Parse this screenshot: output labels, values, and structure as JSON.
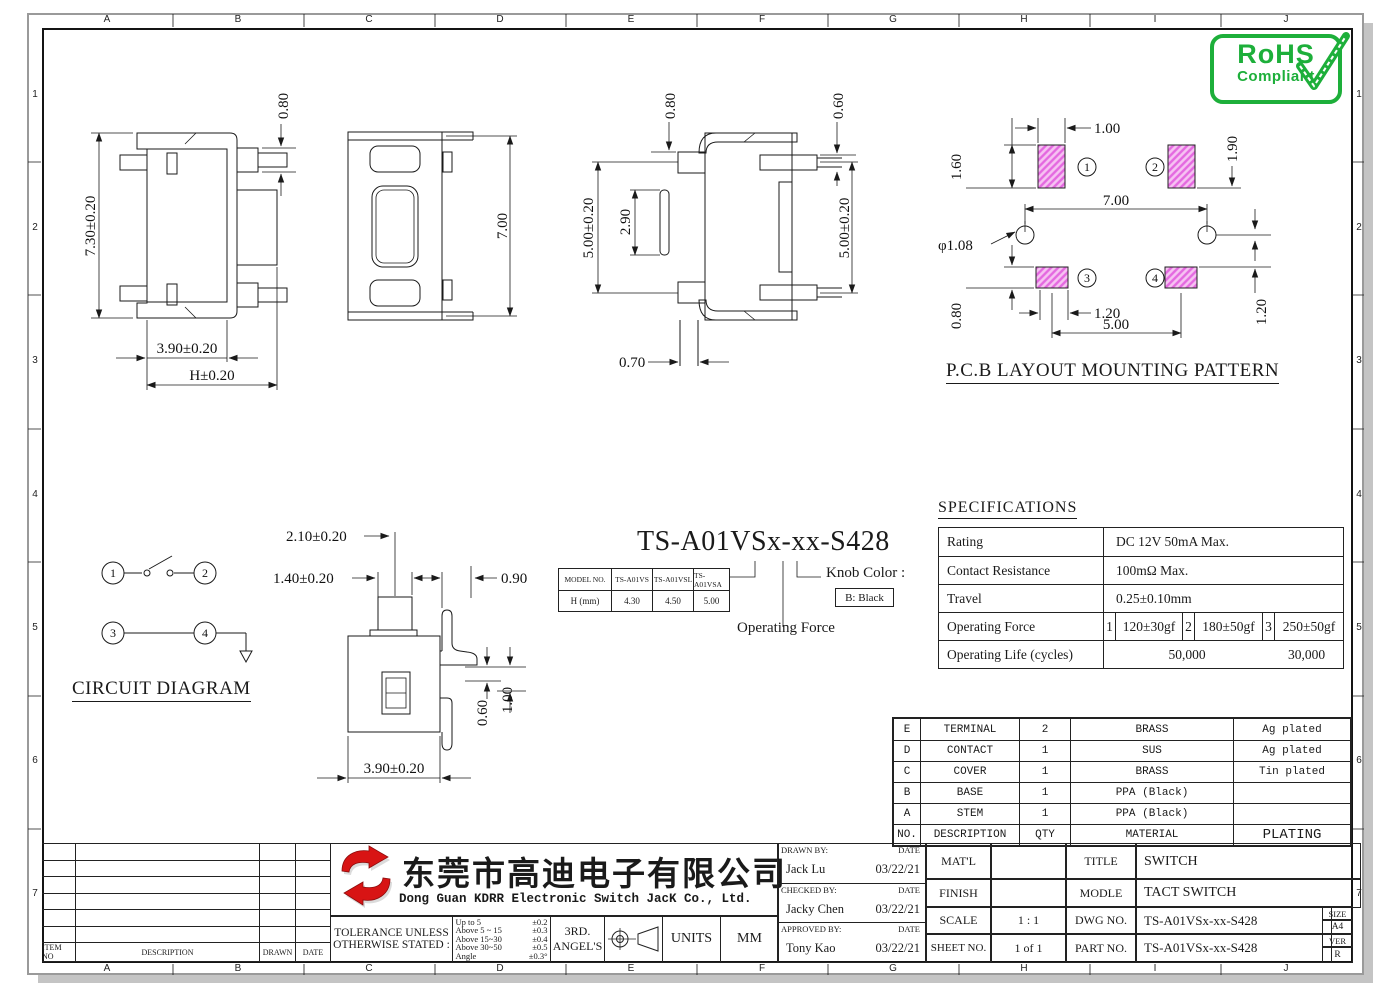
{
  "frame": {
    "grid_letters": [
      "A",
      "B",
      "C",
      "D",
      "E",
      "F",
      "G",
      "H",
      "I",
      "J"
    ],
    "grid_numbers": [
      "1",
      "2",
      "3",
      "4",
      "5",
      "6",
      "7"
    ]
  },
  "rohs": {
    "title": "RoHS",
    "subtitle": "Compliant",
    "color": "#1daf3a"
  },
  "views": {
    "front": {
      "d080": "0.80",
      "d730": "7.30±0.20",
      "d390": "3.90±0.20",
      "dH": "H±0.20"
    },
    "top": {
      "d700": "7.00"
    },
    "side": {
      "d080": "0.80",
      "d060": "0.60",
      "d290": "2.90",
      "d500a": "5.00±0.20",
      "d500b": "5.00±0.20",
      "d070": "0.70"
    },
    "pcb": {
      "title": "P.C.B LAYOUT MOUNTING PATTERN",
      "d100": "1.00",
      "d190": "1.90",
      "d160": "1.60",
      "d700": "7.00",
      "dphi": "φ1.08",
      "d120r": "1.20",
      "d080": "0.80",
      "d120b": "1.20",
      "d500": "5.00",
      "pad1": "1",
      "pad2": "2",
      "pad3": "3",
      "pad4": "4",
      "pad_color": "#ee82ee"
    },
    "circuit": {
      "title": "CIRCUIT DIAGRAM",
      "pin1": "1",
      "pin2": "2",
      "pin3": "3",
      "pin4": "4"
    },
    "section": {
      "d210": "2.10±0.20",
      "d140": "1.40±0.20",
      "d090": "0.90",
      "d060": "0.60",
      "d100": "1.00",
      "d390": "3.90±0.20"
    }
  },
  "part_number": {
    "code": "TS-A01VSx-xx-S428",
    "model_header": [
      "MODEL NO.",
      "TS-A01VS",
      "TS-A01VSL",
      "TS-A01VSA"
    ],
    "model_row": [
      "H (mm)",
      "4.30",
      "4.50",
      "5.00"
    ],
    "knob_label": "Knob Color :",
    "knob_value": "B: Black",
    "force_label": "Operating Force"
  },
  "specifications": {
    "title": "SPECIFICATIONS",
    "rating_label": "Rating",
    "rating_value": "DC 12V 50mA Max.",
    "contact_label": "Contact Resistance",
    "contact_value": "100mΩ Max.",
    "travel_label": "Travel",
    "travel_value": "0.25±0.10mm",
    "force_label": "Operating Force",
    "force_1_no": "1",
    "force_1": "120±30gf",
    "force_2_no": "2",
    "force_2": "180±50gf",
    "force_3_no": "3",
    "force_3": "250±50gf",
    "life_label": "Operating Life (cycles)",
    "life_50": "50,000",
    "life_30": "30,000"
  },
  "bom": {
    "rows": [
      {
        "no": "E",
        "desc": "TERMINAL",
        "qty": "2",
        "material": "BRASS",
        "plating": "Ag plated"
      },
      {
        "no": "D",
        "desc": "CONTACT",
        "qty": "1",
        "material": "SUS",
        "plating": "Ag plated"
      },
      {
        "no": "C",
        "desc": "COVER",
        "qty": "1",
        "material": "BRASS",
        "plating": "Tin plated"
      },
      {
        "no": "B",
        "desc": "BASE",
        "qty": "1",
        "material": "PPA (Black)",
        "plating": ""
      },
      {
        "no": "A",
        "desc": "STEM",
        "qty": "1",
        "material": "PPA (Black)",
        "plating": ""
      }
    ],
    "header": {
      "no": "NO.",
      "desc": "DESCRIPTION",
      "qty": "QTY",
      "material": "MATERIAL",
      "plating": "PLATING"
    }
  },
  "revision": {
    "item_no": "ITEM NO",
    "description": "DESCRIPTION",
    "drawn": "DRAWN",
    "date": "DATE"
  },
  "company": {
    "name_cn": "东莞市高迪电子有限公司",
    "name_en": "Dong Guan KDRR  Electronic Switch JacK Co., Ltd.",
    "logo_color": "#d81414"
  },
  "tolerance": {
    "line1": "TOLERANCE UNLESS",
    "line2": "OTHERWISE STATED :",
    "r1": "Up to 5",
    "t1": "±0.2",
    "r2": "Above 5 ~ 15",
    "t2": "±0.3",
    "r3": "Above 15~30",
    "t3": "±0.4",
    "r4": "Above 30~50",
    "t4": "±0.5",
    "r5": "Angle",
    "t5": "±0.3°",
    "proj1": "3RD.",
    "proj2": "ANGEL'S",
    "units": "UNITS",
    "mm": "MM"
  },
  "titleblock": {
    "drawn_by_label": "DRAWN BY:",
    "checked_by_label": "CHECKED BY:",
    "approved_by_label": "APPROVED BY:",
    "date_label": "DATE",
    "drawn_by": "Jack Lu",
    "drawn_date": "03/22/21",
    "checked_by": "Jacky Chen",
    "checked_date": "03/22/21",
    "approved_by": "Tony Kao",
    "approved_date": "03/22/21",
    "matl_label": "MAT'L",
    "matl_value": "",
    "finish_label": "FINISH",
    "finish_value": "",
    "scale_label": "SCALE",
    "scale_value": "1 : 1",
    "sheet_label": "SHEET NO.",
    "sheet_value": "1 of 1",
    "title_label": "TITLE",
    "title_value": "SWITCH",
    "model_label": "MODLE",
    "model_value": "TACT SWITCH",
    "dwg_label": "DWG NO.",
    "dwg_value": "TS-A01VSx-xx-S428",
    "part_label": "PART NO.",
    "part_value": "TS-A01VSx-xx-S428",
    "size_label": "SIZE",
    "size_value": "A4",
    "ver_label": "VER",
    "ver_value": "R"
  }
}
